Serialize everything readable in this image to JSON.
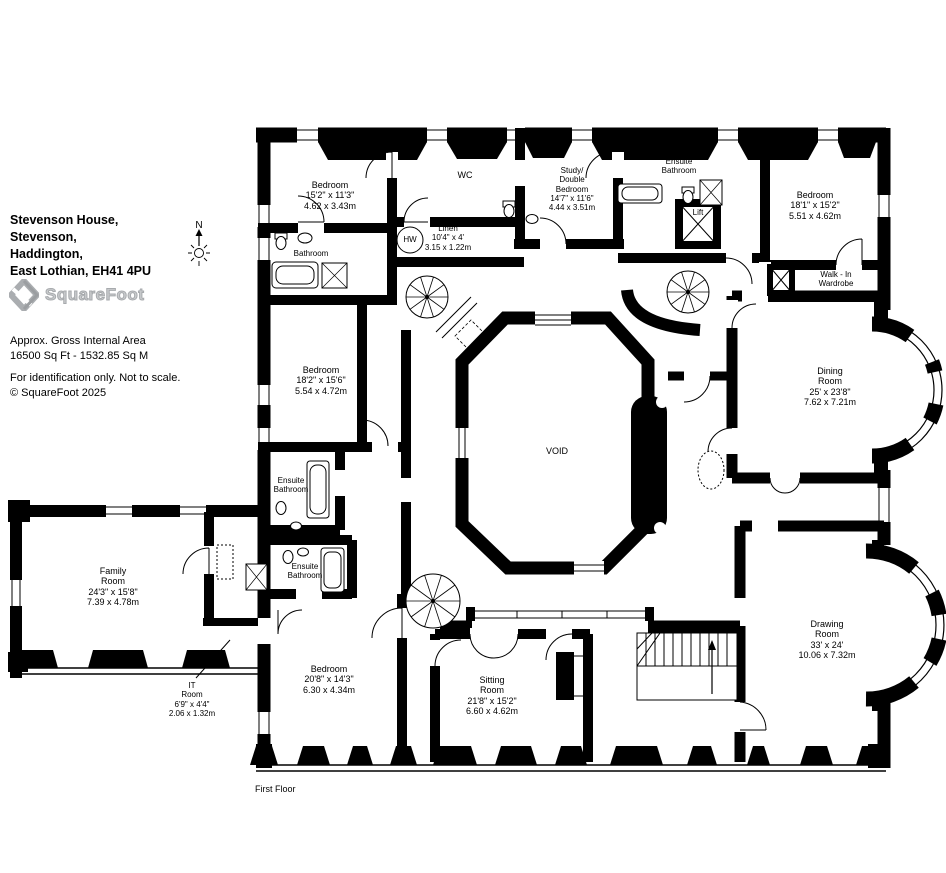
{
  "info": {
    "address_line1": "Stevenson House,",
    "address_line2": "Stevenson,",
    "address_line3": "Haddington,",
    "address_line4": "East Lothian, EH41 4PU",
    "brand": "SquareFoot",
    "area_label": "Approx. Gross Internal Area",
    "area_value": "16500 Sq Ft - 1532.85 Sq M",
    "disclaimer": "For identification only. Not to scale.",
    "copyright": "© SquareFoot 2025",
    "floor_label": "First Floor",
    "compass_north": "N"
  },
  "rooms": {
    "bedroom_top_left": {
      "name": "Bedroom",
      "dims_ft": "15'2\" x 11'3\"",
      "dims_m": "4.62 x 3.43m"
    },
    "wc": {
      "name": "WC"
    },
    "bathroom": {
      "name": "Bathroom"
    },
    "hot_water": {
      "name": "HW"
    },
    "linen": {
      "name": "Linen",
      "dims_ft": "10'4\" x 4'",
      "dims_m": "3.15 x 1.22m"
    },
    "study_double_bedroom": {
      "name": "Study/",
      "name2": "Double",
      "name3": "Bedroom",
      "dims_ft": "14'7\" x 11'6\"",
      "dims_m": "4.44 x 3.51m"
    },
    "ensuite_bathroom_top": {
      "name": "Ensuite",
      "name2": "Bathroom"
    },
    "lift": {
      "name": "Lift"
    },
    "bedroom_top_right": {
      "name": "Bedroom",
      "dims_ft": "18'1\" x 15'2\"",
      "dims_m": "5.51 x 4.62m"
    },
    "walk_in_wardrobe": {
      "name": "Walk - In",
      "name2": "Wardrobe"
    },
    "bedroom_mid_left": {
      "name": "Bedroom",
      "dims_ft": "18'2\" x 15'6\"",
      "dims_m": "5.54 x 4.72m"
    },
    "ensuite_bathroom_mid": {
      "name": "Ensuite",
      "name2": "Bathroom"
    },
    "dining_room": {
      "name": "Dining",
      "name2": "Room",
      "dims_ft": "25' x 23'8\"",
      "dims_m": "7.62 x 7.21m"
    },
    "void": {
      "name": "VOID"
    },
    "ensuite_bathroom_lower": {
      "name": "Ensuite",
      "name2": "Bathroom"
    },
    "family_room": {
      "name": "Family",
      "name2": "Room",
      "dims_ft": "24'3\" x 15'8\"",
      "dims_m": "7.39 x 4.78m"
    },
    "it_room": {
      "name": "IT",
      "name2": "Room",
      "dims_ft": "6'9\" x 4'4\"",
      "dims_m": "2.06 x 1.32m"
    },
    "bedroom_bottom_left": {
      "name": "Bedroom",
      "dims_ft": "20'8\" x 14'3\"",
      "dims_m": "6.30 x 4.34m"
    },
    "sitting_room": {
      "name": "Sitting",
      "name2": "Room",
      "dims_ft": "21'8\" x 15'2\"",
      "dims_m": "6.60 x 4.62m"
    },
    "drawing_room": {
      "name": "Drawing",
      "name2": "Room",
      "dims_ft": "33' x 24'",
      "dims_m": "10.06 x 7.32m"
    }
  },
  "colors": {
    "wall": "#000000",
    "background": "#ffffff",
    "logo_gray": "#b5b5b5"
  }
}
